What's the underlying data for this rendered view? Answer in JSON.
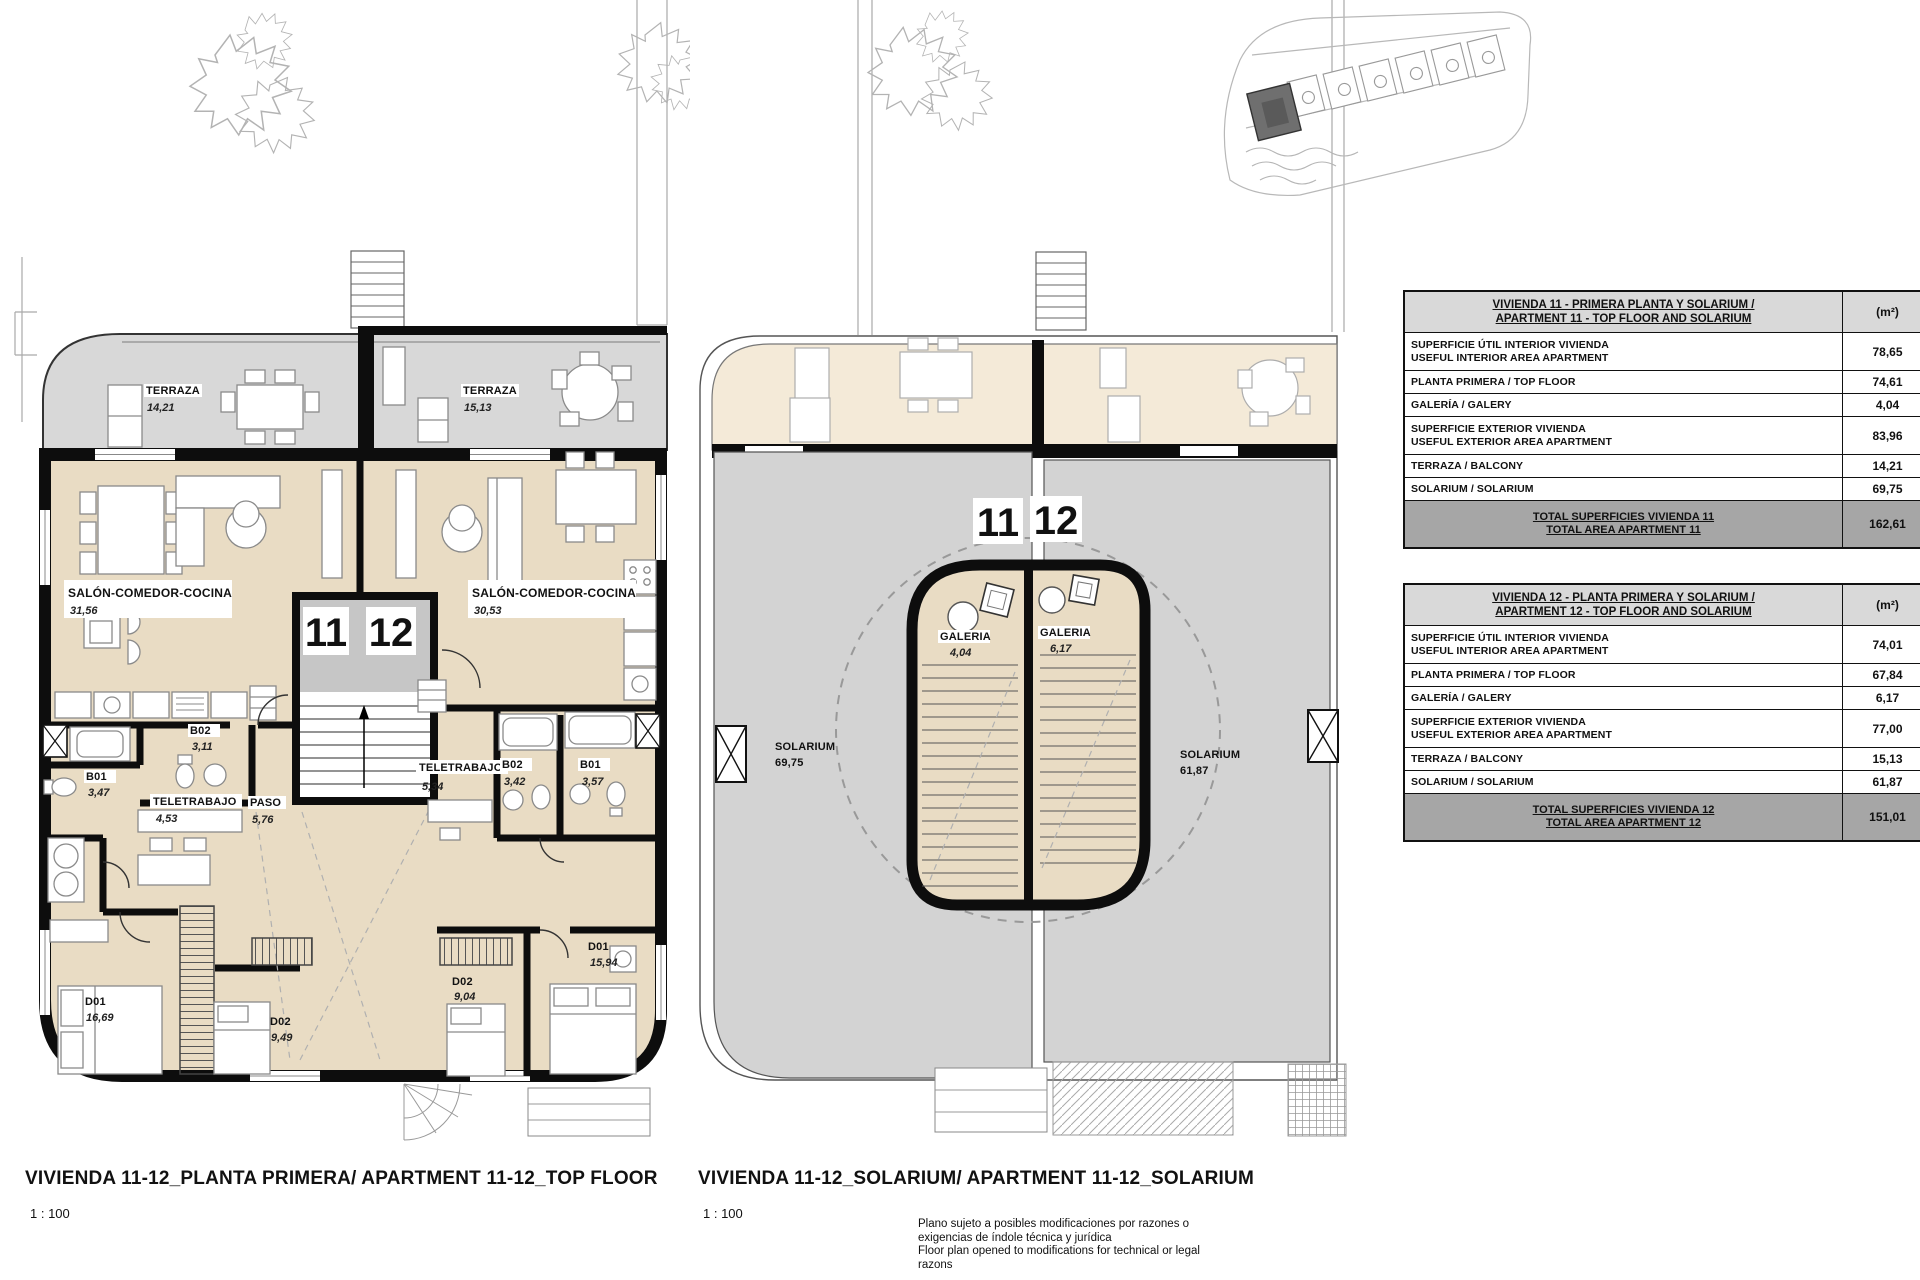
{
  "plan_top_floor": {
    "caption": "VIVIENDA 11-12_PLANTA PRIMERA/ APARTMENT 11-12_TOP FLOOR",
    "scale": "1 : 100",
    "unit11": "11",
    "unit12": "12",
    "terraza11": {
      "name": "TERRAZA",
      "area": "14,21"
    },
    "terraza12": {
      "name": "TERRAZA",
      "area": "15,13"
    },
    "salon11": {
      "name": "SALÓN-COMEDOR-COCINA",
      "area": "31,56"
    },
    "salon12": {
      "name": "SALÓN-COMEDOR-COCINA",
      "area": "30,53"
    },
    "b01_11": {
      "name": "B01",
      "area": "3,47"
    },
    "b02_11": {
      "name": "B02",
      "area": "3,11"
    },
    "tele11": {
      "name": "TELETRABAJO",
      "area": "4,53"
    },
    "paso": {
      "name": "PASO",
      "area": "5,76"
    },
    "d01_11": {
      "name": "D01",
      "area": "16,69"
    },
    "d02_11": {
      "name": "D02",
      "area": "9,49"
    },
    "tele12": {
      "name": "TELETRABAJO",
      "area": "5,34"
    },
    "b02_12": {
      "name": "B02",
      "area": "3,42"
    },
    "b01_12": {
      "name": "B01",
      "area": "3,57"
    },
    "d02_12": {
      "name": "D02",
      "area": "9,04"
    },
    "d01_12": {
      "name": "D01",
      "area": "15,94"
    }
  },
  "plan_solarium": {
    "caption": "VIVIENDA 11-12_SOLARIUM/ APARTMENT 11-12_SOLARIUM",
    "scale": "1 : 100",
    "unit11": "11",
    "unit12": "12",
    "galeria11": {
      "name": "GALERIA",
      "area": "4,04"
    },
    "galeria12": {
      "name": "GALERIA",
      "area": "6,17"
    },
    "solarium11": {
      "name": "SOLARIUM",
      "area": "69,75"
    },
    "solarium12": {
      "name": "SOLARIUM",
      "area": "61,87"
    }
  },
  "tables": [
    {
      "title_line1": "VIVIENDA 11 - PRIMERA PLANTA Y SOLARIUM /",
      "title_line2": "APARTMENT 11 - TOP FLOOR AND SOLARIUM",
      "unit_header": "(m²)",
      "rows": [
        {
          "line1": "SUPERFICIE ÚTIL INTERIOR VIVIENDA",
          "line2": "USEFUL INTERIOR AREA APARTMENT",
          "value": "78,65"
        },
        {
          "line1": "PLANTA PRIMERA / TOP FLOOR",
          "line2": "",
          "value": "74,61"
        },
        {
          "line1": "GALERÍA / GALERY",
          "line2": "",
          "value": "4,04"
        },
        {
          "line1": "SUPERFICIE EXTERIOR VIVIENDA",
          "line2": "USEFUL EXTERIOR AREA APARTMENT",
          "value": "83,96"
        },
        {
          "line1": "TERRAZA / BALCONY",
          "line2": "",
          "value": "14,21"
        },
        {
          "line1": "SOLARIUM / SOLARIUM",
          "line2": "",
          "value": "69,75"
        }
      ],
      "total_line1": "TOTAL SUPERFICIES VIVIENDA 11",
      "total_line2": "TOTAL AREA APARTMENT 11",
      "total_value": "162,61"
    },
    {
      "title_line1": "VIVIENDA 12 - PLANTA PRIMERA Y SOLARIUM /",
      "title_line2": "APARTMENT 12 - TOP FLOOR AND SOLARIUM",
      "unit_header": "(m²)",
      "rows": [
        {
          "line1": "SUPERFICIE ÚTIL INTERIOR VIVIENDA",
          "line2": "USEFUL INTERIOR AREA APARTMENT",
          "value": "74,01"
        },
        {
          "line1": "PLANTA PRIMERA / TOP FLOOR",
          "line2": "",
          "value": "67,84"
        },
        {
          "line1": "GALERÍA / GALERY",
          "line2": "",
          "value": "6,17"
        },
        {
          "line1": "SUPERFICIE EXTERIOR VIVIENDA",
          "line2": "USEFUL EXTERIOR AREA APARTMENT",
          "value": "77,00"
        },
        {
          "line1": "TERRAZA / BALCONY",
          "line2": "",
          "value": "15,13"
        },
        {
          "line1": "SOLARIUM / SOLARIUM",
          "line2": "",
          "value": "61,87"
        }
      ],
      "total_line1": "TOTAL SUPERFICIES VIVIENDA 12",
      "total_line2": "TOTAL AREA APARTMENT 12",
      "total_value": "151,01"
    }
  ],
  "disclaimer": {
    "l1": "Plano sujeto a posibles modificaciones por razones o",
    "l2": "exigencias de índole técnica y jurídica",
    "l3": "Floor plan opened to modifications for technical or legal",
    "l4": "razons"
  },
  "colors": {
    "interior_beige": "#e9dcc4",
    "terrace_gray": "#d8d8d8",
    "solarium_gray": "#d3d3d3",
    "solarium_terrace_beige": "#f4ead8",
    "wall_black": "#0d0d0d",
    "table_header_bg": "#d9d9d9",
    "table_total_bg": "#a6a6a6",
    "site_highlight": "#6f6f6f"
  }
}
